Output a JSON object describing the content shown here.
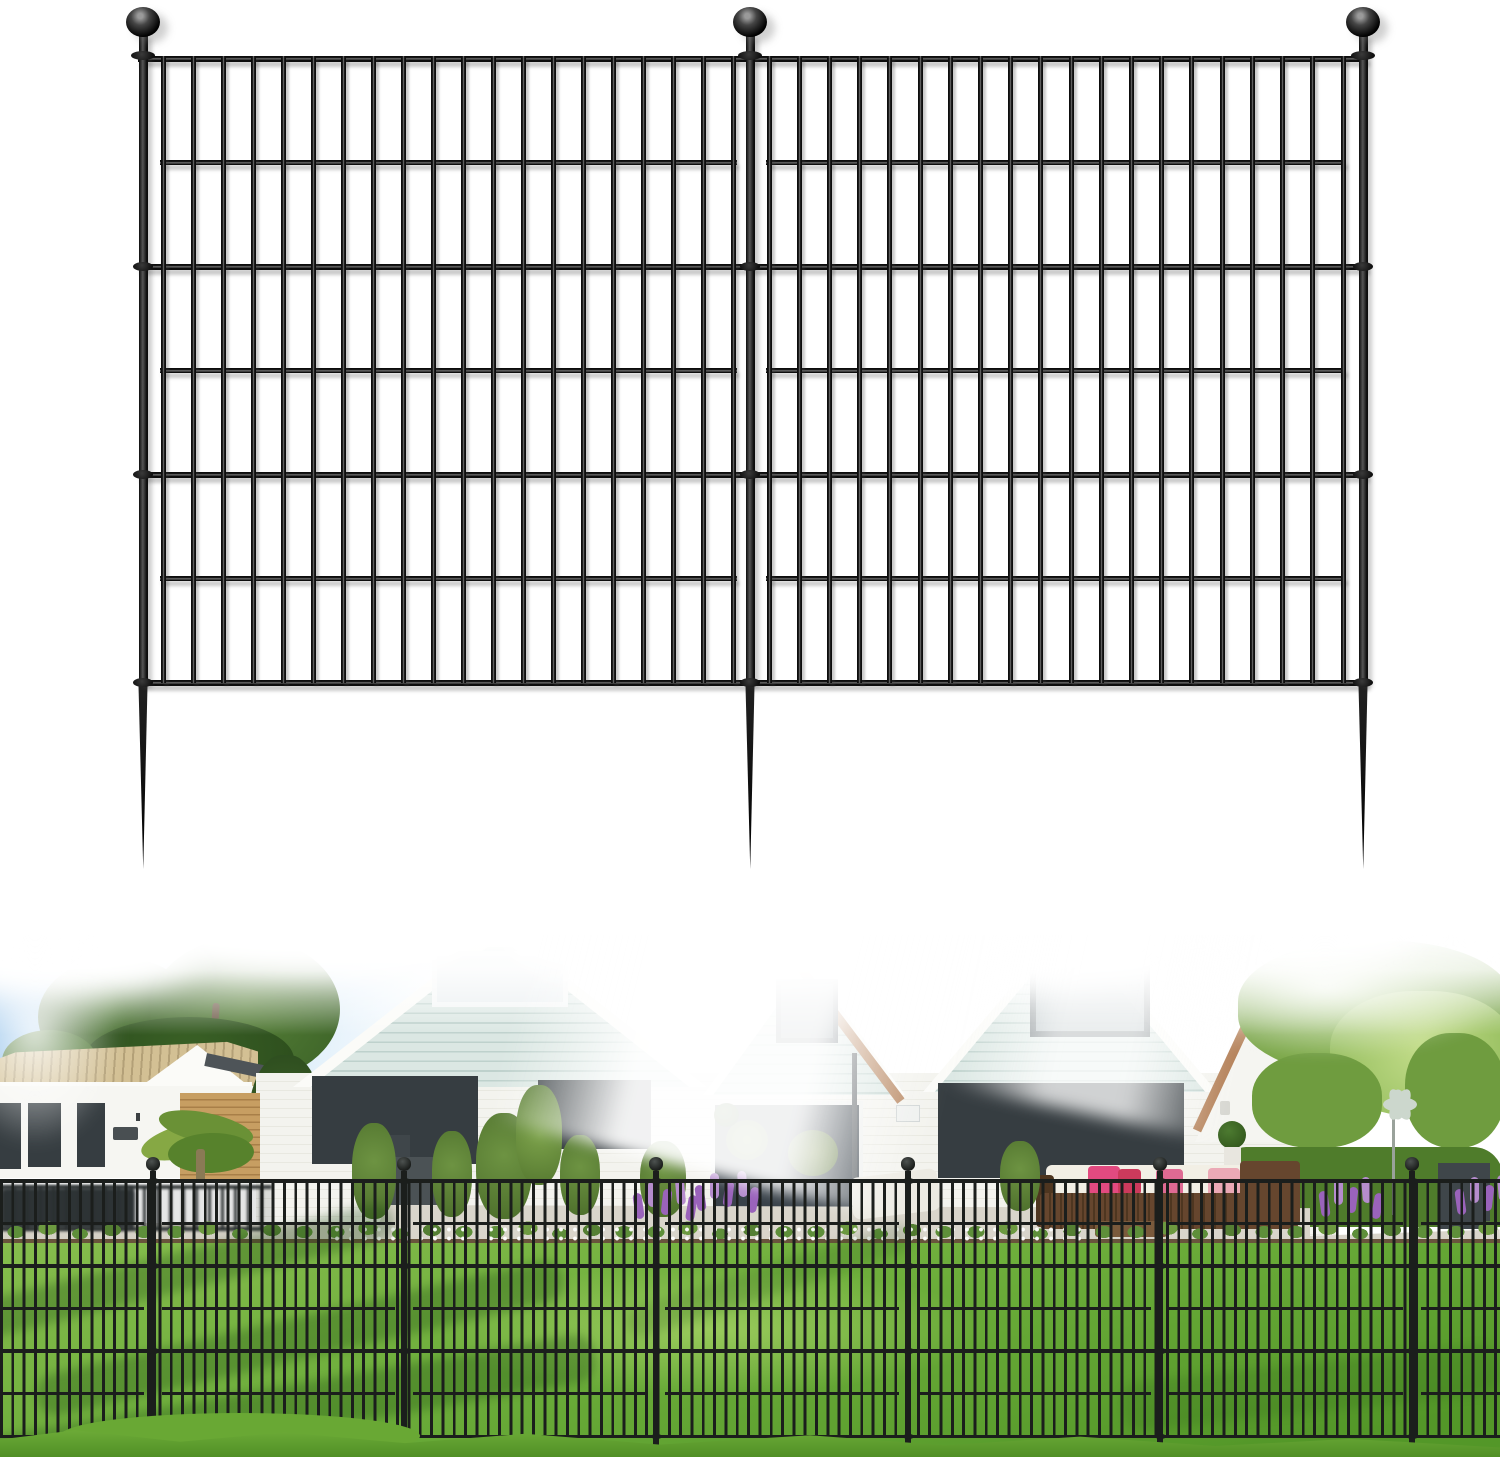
{
  "meta": {
    "image_type": "product-image",
    "subject": "black metal no-dig garden fence panels with ball-top stakes",
    "background": "#ffffff"
  },
  "palette": {
    "sky1": "#86bae7",
    "sky2": "#c8e3f6",
    "treeDark": "#2d4e1d",
    "tree1": "#4a7430",
    "tree2": "#567f38",
    "tree3": "#3a6126",
    "roofTan1": "#d3c094",
    "roofTan2": "#b3a077",
    "white1": "#f6f6f2",
    "winFrame": "#363d41",
    "louver1": "#f2f4f4",
    "louver2": "#c3ccd0",
    "brick1": "#c79e62",
    "brick2": "#a87f48",
    "mint1": "#dbe7e3",
    "mint2": "#bed1cc",
    "whiteBrick": "#f3f3ee",
    "whiteBrickLine": "#e8e8e0",
    "terra": "#b5825a",
    "treeR1": "#8cb755",
    "treeR2": "#6f9c3f",
    "treeR3": "#c3dd8a",
    "hedge": "#4f7c2b",
    "palm1": "#86a844",
    "palm2": "#6a9136",
    "palm3": "#57822c",
    "lawn1": "#86bd4d",
    "lawn2": "#6cad3a",
    "lawn3": "#539728",
    "lawnShadow": "rgba(24,68,12,0.30)",
    "soil": "#5a452c",
    "bedGreen": "#5e8f3a",
    "purple": "#9a63bb",
    "purple2": "#b58ccd",
    "paving": "#d9d5cb",
    "wicker": "#66462e",
    "wickerDark": "#4e3620",
    "cushionWhite": "#f2efe5",
    "pink": "#e24a80",
    "red": "#cc3a5c",
    "salmon": "#eba9b6",
    "planter": "#3f464a",
    "spinner": "#ccd7cd"
  },
  "diagram": {
    "metal": {
      "dark": "#0d0d0d",
      "mid": "#1a1a1a",
      "highlight": "#5e5e5e",
      "shadow": "rgba(70,70,70,0.28)"
    },
    "posts": {
      "xs": [
        143,
        750,
        1363
      ],
      "width": 9,
      "top": 34,
      "bottom": 684
    },
    "balls": {
      "cy": 22,
      "rx": 17,
      "ry": 15
    },
    "neck_collar": {
      "y": 51,
      "w": 24,
      "h": 9
    },
    "rails_full": {
      "ys": [
        56,
        264,
        472,
        680
      ],
      "h": 5.5,
      "x1": 138,
      "x2": 1368
    },
    "rails_inset": {
      "ys": [
        160,
        368,
        576
      ],
      "h": 5
    },
    "panels": [
      {
        "bar_first": 163,
        "bar_last": 733,
        "bars": 20,
        "inset_x1": 160,
        "inset_x2": 737
      },
      {
        "bar_first": 769,
        "bar_last": 1343,
        "bars": 20,
        "inset_x1": 766,
        "inset_x2": 1346
      }
    ],
    "bar": {
      "w": 5,
      "top": 56,
      "bottom": 683
    },
    "spike": {
      "top": 683,
      "len": 186,
      "w": 12
    }
  },
  "photo_fence": {
    "color": "#1b1e1c",
    "posts": [
      153,
      404,
      656,
      908,
      1160,
      1412
    ],
    "post_w": 6.5,
    "post_top": 236,
    "post_bottom": 510,
    "ball": {
      "cy": 229,
      "rx": 7.2,
      "ry": 6.6
    },
    "rail_top": 244,
    "rail_step": 42.6,
    "rail_count": 7,
    "rail_h_full": 3.8,
    "rail_h_inset": 3,
    "panel_inset": 9,
    "bars": {
      "top": 246,
      "bottom": 502,
      "period": 11.32,
      "width": 2.9
    }
  }
}
